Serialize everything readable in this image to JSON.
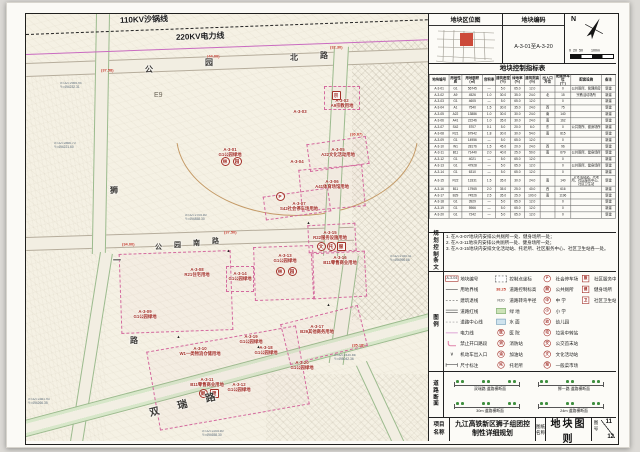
{
  "header": {
    "location_title": "地块区位图",
    "code_title": "地块编码",
    "code_value": "A-3-01至A-3-20",
    "north_label": "N",
    "scale_text": "0  20  50        100m"
  },
  "index_table": {
    "title": "地块控制指标表",
    "columns": [
      "地块编号",
      "用地性质",
      "用地面积\n(㎡)",
      "容积率",
      "建筑密度\n(%)",
      "绿地率\n(%)",
      "建筑限高\n(m)",
      "出入口\n方位",
      "配建停车位\n(个)",
      "配套设施",
      "备注"
    ],
    "rows": [
      [
        "A-3-01",
        "G1",
        "56745",
        "—",
        "5.0",
        "65.0",
        "12.0",
        "",
        "0",
        "公共厕所、管理用房",
        "新建"
      ],
      [
        "A-3-02",
        "A9",
        "4526",
        "1.0",
        "30.0",
        "35.0",
        "24.0",
        "北",
        "15",
        "宗教活动场所",
        "新建"
      ],
      [
        "A-3-03",
        "G1",
        "4605",
        "—",
        "5.0",
        "65.0",
        "12.0",
        "",
        "0",
        "",
        "新建"
      ],
      [
        "A-3-04",
        "A1",
        "7540",
        "1.5",
        "30.0",
        "35.0",
        "24.0",
        "西",
        "75",
        "",
        "新建"
      ],
      [
        "A-3-05",
        "A22",
        "13886",
        "1.0",
        "30.0",
        "30.0",
        "24.0",
        "南",
        "140",
        "",
        "新建"
      ],
      [
        "A-3-06",
        "A41",
        "22246",
        "1.0",
        "35.0",
        "30.0",
        "24.0",
        "南",
        "162",
        "",
        "新建"
      ],
      [
        "A-3-07",
        "S42",
        "5707",
        "0.1",
        "5.0",
        "20.0",
        "6.0",
        "东",
        "0",
        "公共厕所、健身场所",
        "新建"
      ],
      [
        "A-3-08",
        "R21",
        "67942",
        "1.8",
        "30.0",
        "30.0",
        "54.0",
        "南",
        "815",
        "",
        "新建"
      ],
      [
        "A-3-09",
        "G1",
        "14956",
        "—",
        "5.0",
        "65.0",
        "12.0",
        "",
        "0",
        "",
        "新建"
      ],
      [
        "A-3-10",
        "W1",
        "28176",
        "1.5",
        "45.0",
        "20.0",
        "24.0",
        "西",
        "96",
        "",
        "新建"
      ],
      [
        "A-3-11",
        "B11",
        "71440",
        "2.0",
        "40.0",
        "25.0",
        "50.0",
        "南",
        "679",
        "公共厕所、健身场所",
        "新建"
      ],
      [
        "A-3-12",
        "G1",
        "4021",
        "—",
        "5.0",
        "65.0",
        "12.0",
        "",
        "0",
        "",
        "新建"
      ],
      [
        "A-3-13",
        "G1",
        "47928",
        "—",
        "5.0",
        "65.0",
        "12.0",
        "",
        "0",
        "公共厕所、健身场所",
        "新建"
      ],
      [
        "A-3-14",
        "G1",
        "6310",
        "—",
        "5.0",
        "65.0",
        "12.0",
        "",
        "0",
        "",
        "新建"
      ],
      [
        "A-3-15",
        "R22",
        "13331",
        "1.5",
        "35.0",
        "30.0",
        "24.0",
        "南",
        "140",
        "文化活动站、托老所、社区服务中心、社区卫生站",
        "新建"
      ],
      [
        "A-3-16",
        "B11",
        "17965",
        "2.0",
        "35.0",
        "25.0",
        "40.0",
        "西",
        "616",
        "",
        "新建"
      ],
      [
        "A-3-17",
        "B29",
        "74526",
        "2.5",
        "35.0",
        "25.0",
        "100.0",
        "南",
        "1196",
        "",
        "新建"
      ],
      [
        "A-3-18",
        "G1",
        "3929",
        "—",
        "5.0",
        "65.0",
        "12.0",
        "",
        "0",
        "",
        "新建"
      ],
      [
        "A-3-19",
        "G1",
        "5966",
        "—",
        "5.0",
        "65.0",
        "12.0",
        "",
        "0",
        "",
        "新建"
      ],
      [
        "A-3-20",
        "G1",
        "7242",
        "—",
        "5.0",
        "65.0",
        "12.0",
        "",
        "0",
        "",
        "新建"
      ]
    ]
  },
  "provisions": {
    "label": "规划控制条文",
    "items": [
      "1. 在A-3-07地块内安排公共厕所一处、健身场所一处；",
      "2. 在A-3-11地块内安排公共厕所一处、健身场所一处；",
      "3. 在A-3-15地块内安排文化活动站、托老所、社区服务中心、社区卫生站各一处。"
    ]
  },
  "legend": {
    "label": "图例",
    "columns": [
      [
        {
          "s": "plotbox",
          "g": "A-3-04",
          "t": "地块编号"
        },
        {
          "s": "line",
          "t": "用地界线"
        },
        {
          "s": "dash",
          "t": "建筑退线"
        },
        {
          "s": "dbl",
          "t": "道路红线"
        },
        {
          "s": "cl",
          "t": "道路中心线"
        },
        {
          "s": "pink",
          "t": "电力线"
        },
        {
          "s": "corner",
          "t": "禁止开口路段"
        },
        {
          "s": "arrv",
          "g": "∨",
          "t": "机动车出入口"
        },
        {
          "s": "dim",
          "t": "尺寸标注"
        }
      ],
      [
        {
          "s": "coordb",
          "t": "控制点坐标"
        },
        {
          "s": "rednum",
          "g": "38.25",
          "t": "道路控制标高"
        },
        {
          "s": "rad",
          "g": "R20",
          "t": "道路转弯半径"
        },
        {
          "s": "green",
          "t": "绿 地"
        },
        {
          "s": "water",
          "t": "水 面"
        },
        {
          "s": "circ",
          "g": "医",
          "t": "医 院"
        },
        {
          "s": "circ",
          "g": "消",
          "t": "消防站"
        },
        {
          "s": "circ",
          "g": "油",
          "t": "加油站"
        },
        {
          "s": "circ",
          "g": "托",
          "t": "托老所"
        }
      ],
      [
        {
          "s": "circ",
          "g": "P",
          "t": "社会停车场"
        },
        {
          "s": "circ",
          "g": "厕",
          "t": "公共厕所"
        },
        {
          "s": "circ",
          "g": "中",
          "t": "中 学"
        },
        {
          "s": "circ",
          "g": "小",
          "t": "小 学"
        },
        {
          "s": "circ",
          "g": "幼",
          "t": "幼儿园"
        },
        {
          "s": "circ",
          "g": "垃",
          "t": "垃圾中转站"
        },
        {
          "s": "circ",
          "g": "交",
          "t": "公交首末站"
        },
        {
          "s": "circ",
          "g": "文",
          "t": "文化活动站"
        },
        {
          "s": "circ",
          "g": "菜",
          "t": "一般菜市场"
        }
      ],
      [
        {
          "s": "sq",
          "g": "服",
          "t": "社区服务中心"
        },
        {
          "s": "sq",
          "g": "健",
          "t": "健身场所"
        },
        {
          "s": "sq",
          "g": "卫",
          "t": "社区卫生站"
        }
      ]
    ]
  },
  "road_sections": {
    "label": "道路断面",
    "items": [
      "双瑞路 道路横断面",
      "狮一路 道路横断面",
      "30m 道路横断面",
      "24m 道路横断面"
    ]
  },
  "titleblock": {
    "project_label": "项目名称",
    "project_name": "九江高铁新区狮子组团控制性详细规划",
    "drawing_label": "图纸名称",
    "drawing_name": "地块图则",
    "sheet_label": "图号",
    "sheet_no": "11",
    "sheet_total": "12"
  },
  "map": {
    "area_label": "E9",
    "power_lines": [
      {
        "name": "110KV沙锅线"
      },
      {
        "name": "220KV电力线"
      }
    ],
    "plots": [
      {
        "id": "A-3-01",
        "use": "G1公园绿地",
        "x": 204,
        "y": 138
      },
      {
        "id": "A-3-02",
        "use": "A9宗教用地",
        "x": 316,
        "y": 89
      },
      {
        "id": "A-3-03",
        "use": "",
        "x": 274,
        "y": 100
      },
      {
        "id": "A-3-04",
        "use": "",
        "x": 271,
        "y": 150
      },
      {
        "id": "A-3-05",
        "use": "A22文化活动用地",
        "x": 312,
        "y": 138
      },
      {
        "id": "A-3-06",
        "use": "A41体育场馆用地",
        "x": 306,
        "y": 170
      },
      {
        "id": "A-3-07",
        "use": "S42社会停车场用地",
        "x": 273,
        "y": 192
      },
      {
        "id": "A-3-08",
        "use": "R21住宅用地",
        "x": 171,
        "y": 258
      },
      {
        "id": "A-3-09",
        "use": "G1公园绿地",
        "x": 119,
        "y": 300
      },
      {
        "id": "A-3-10",
        "use": "W1一类物流仓储用地",
        "x": 174,
        "y": 337
      },
      {
        "id": "A-3-11",
        "use": "B11零售商业用地",
        "x": 181,
        "y": 368
      },
      {
        "id": "A-3-12",
        "use": "G1公园绿地",
        "x": 213,
        "y": 373
      },
      {
        "id": "A-3-13",
        "use": "G1公园绿地",
        "x": 259,
        "y": 244
      },
      {
        "id": "A-3-14",
        "use": "G1公园绿地",
        "x": 214,
        "y": 262
      },
      {
        "id": "A-3-15",
        "use": "R22服务设施用地",
        "x": 304,
        "y": 221
      },
      {
        "id": "A-3-16",
        "use": "B11零售商业用地",
        "x": 314,
        "y": 246
      },
      {
        "id": "A-3-17",
        "use": "B29其他商务用地",
        "x": 291,
        "y": 315
      },
      {
        "id": "A-3-18",
        "use": "G1公园绿地",
        "x": 240,
        "y": 336
      },
      {
        "id": "A-3-19",
        "use": "G1公园绿地",
        "x": 225,
        "y": 325
      },
      {
        "id": "A-3-20",
        "use": "G1公园绿地",
        "x": 276,
        "y": 351
      }
    ],
    "icons": [
      {
        "g": "林",
        "x": 198,
        "y": 146
      },
      {
        "g": "园",
        "x": 210,
        "y": 146
      },
      {
        "g": "林",
        "x": 253,
        "y": 256
      },
      {
        "g": "园",
        "x": 265,
        "y": 256
      },
      {
        "g": "P",
        "x": 253,
        "y": 181
      },
      {
        "g": "宗",
        "x": 309,
        "y": 80,
        "sq": true
      },
      {
        "g": "文",
        "x": 294,
        "y": 231
      },
      {
        "g": "托",
        "x": 304,
        "y": 231
      },
      {
        "g": "服",
        "x": 314,
        "y": 231,
        "sq": true
      },
      {
        "g": "厕",
        "x": 176,
        "y": 378
      },
      {
        "g": "健",
        "x": 187,
        "y": 378,
        "sq": true
      }
    ],
    "elevations": [
      {
        "v": "(44.00)",
        "x": 181,
        "y": 41
      },
      {
        "v": "(37.58)",
        "x": 75,
        "y": 55
      },
      {
        "v": "(32.30)",
        "x": 304,
        "y": 32
      },
      {
        "v": "(34.00)",
        "x": 96,
        "y": 229
      },
      {
        "v": "(37.50)",
        "x": 198,
        "y": 217
      },
      {
        "v": "(36.67)",
        "x": 324,
        "y": 119
      },
      {
        "v": "(35.18)",
        "x": 326,
        "y": 330
      }
    ],
    "coords": [
      {
        "t": "X=3272985.94\nY=494232.31",
        "x": 34,
        "y": 68
      },
      {
        "t": "X=3272866.70\nY=494221.60",
        "x": 28,
        "y": 128
      },
      {
        "t": "X=3272705.80\nY=494858.30",
        "x": 159,
        "y": 200
      },
      {
        "t": "X=3272780.41\nY=494996.66",
        "x": 364,
        "y": 241
      },
      {
        "t": "X=3272381.93\nY=494266.35",
        "x": 2,
        "y": 384
      },
      {
        "t": "X=3272430.66\nY=495042.36",
        "x": 308,
        "y": 340
      },
      {
        "t": "X=3272205.80\nY=494658.30",
        "x": 176,
        "y": 416
      }
    ],
    "road_names": [
      {
        "name": "公园北路",
        "size": 8,
        "rot": 0,
        "chars": [
          {
            "c": "公",
            "x": 119,
            "y": 50
          },
          {
            "c": "园",
            "x": 179,
            "y": 43
          },
          {
            "c": "北",
            "x": 264,
            "y": 38
          },
          {
            "c": "路",
            "x": 294,
            "y": 36
          }
        ]
      },
      {
        "name": "公园南路",
        "size": 7,
        "rot": 0,
        "chars": [
          {
            "c": "公",
            "x": 129,
            "y": 228
          },
          {
            "c": "园",
            "x": 148,
            "y": 226
          },
          {
            "c": "南",
            "x": 167,
            "y": 224
          },
          {
            "c": "路",
            "x": 186,
            "y": 222
          }
        ]
      },
      {
        "name": "狮一路",
        "size": 8,
        "rot": 0,
        "chars": [
          {
            "c": "狮",
            "x": 84,
            "y": 171
          },
          {
            "c": "一",
            "x": 87,
            "y": 241
          },
          {
            "c": "路",
            "x": 104,
            "y": 321
          }
        ]
      },
      {
        "name": "双瑞路",
        "size": 10,
        "rot": -15,
        "chars": [
          {
            "c": "双",
            "x": 123,
            "y": 389
          },
          {
            "c": "瑞",
            "x": 151,
            "y": 382
          },
          {
            "c": "路",
            "x": 179,
            "y": 375
          }
        ]
      }
    ],
    "parcels": [
      {
        "x": 298,
        "y": 72,
        "w": 34,
        "h": 22,
        "r": 0
      },
      {
        "x": 282,
        "y": 126,
        "w": 58,
        "h": 26,
        "r": -8
      },
      {
        "x": 274,
        "y": 153,
        "w": 62,
        "h": 40,
        "r": -5
      },
      {
        "x": 238,
        "y": 178,
        "w": 64,
        "h": 22,
        "r": -8
      },
      {
        "x": 94,
        "y": 238,
        "w": 110,
        "h": 78,
        "r": -2
      },
      {
        "x": 228,
        "y": 232,
        "w": 58,
        "h": 52,
        "r": -2
      },
      {
        "x": 200,
        "y": 252,
        "w": 26,
        "h": 24,
        "r": 0
      },
      {
        "x": 282,
        "y": 210,
        "w": 46,
        "h": 26,
        "r": -3
      },
      {
        "x": 286,
        "y": 238,
        "w": 52,
        "h": 44,
        "r": -3
      },
      {
        "x": 126,
        "y": 324,
        "w": 150,
        "h": 78,
        "r": -10
      },
      {
        "x": 258,
        "y": 300,
        "w": 78,
        "h": 40,
        "r": -14
      }
    ],
    "arrows": [
      {
        "x": 200,
        "y": 234
      },
      {
        "x": 150,
        "y": 320
      },
      {
        "x": 280,
        "y": 206
      },
      {
        "x": 300,
        "y": 288
      },
      {
        "x": 230,
        "y": 330
      }
    ]
  }
}
